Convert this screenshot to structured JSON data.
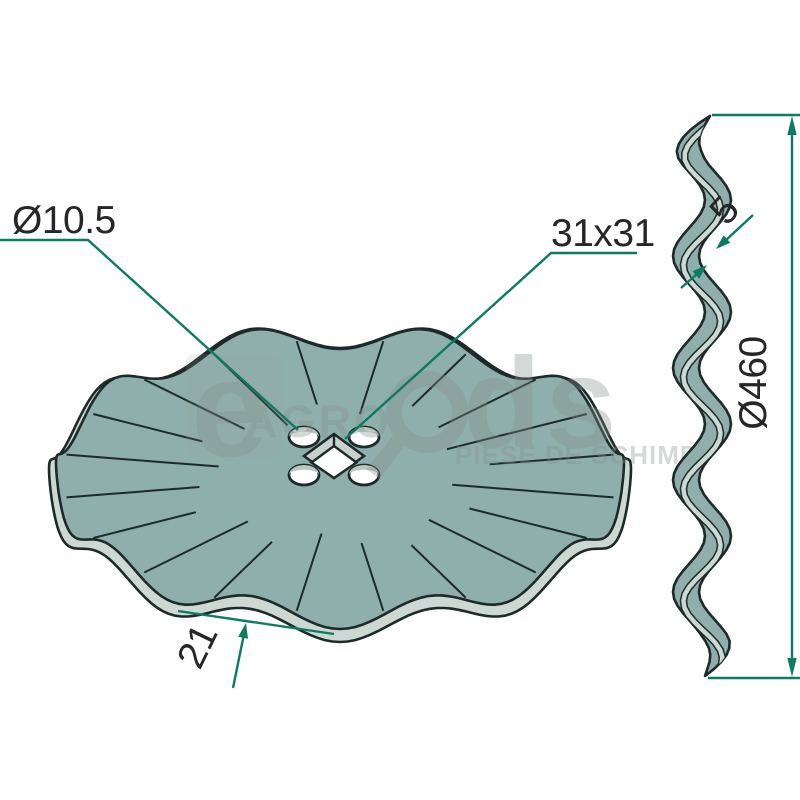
{
  "figure": {
    "type": "technical drawing of wavy coulter disc, front view and side profile",
    "dimensions": {
      "hole_diameter": "Ø10.5",
      "square_bore": "31x31",
      "thickness": "5",
      "disc_diameter": "Ø460",
      "wave_depth": "21"
    },
    "watermark": {
      "e": "e",
      "agro": "AGRO",
      "ds": "ds",
      "tagline": "PIESE DE SCHIMB"
    },
    "colors": {
      "disc_face": "#8fafac",
      "disc_rim": "#cdd8d3",
      "outline": "#1c2b29",
      "dimension": "#0d7a62",
      "watermark_gray": "#848f8b",
      "hole_shade": "#bcc7c4",
      "bevel_gray": "#c9d1ce"
    }
  }
}
